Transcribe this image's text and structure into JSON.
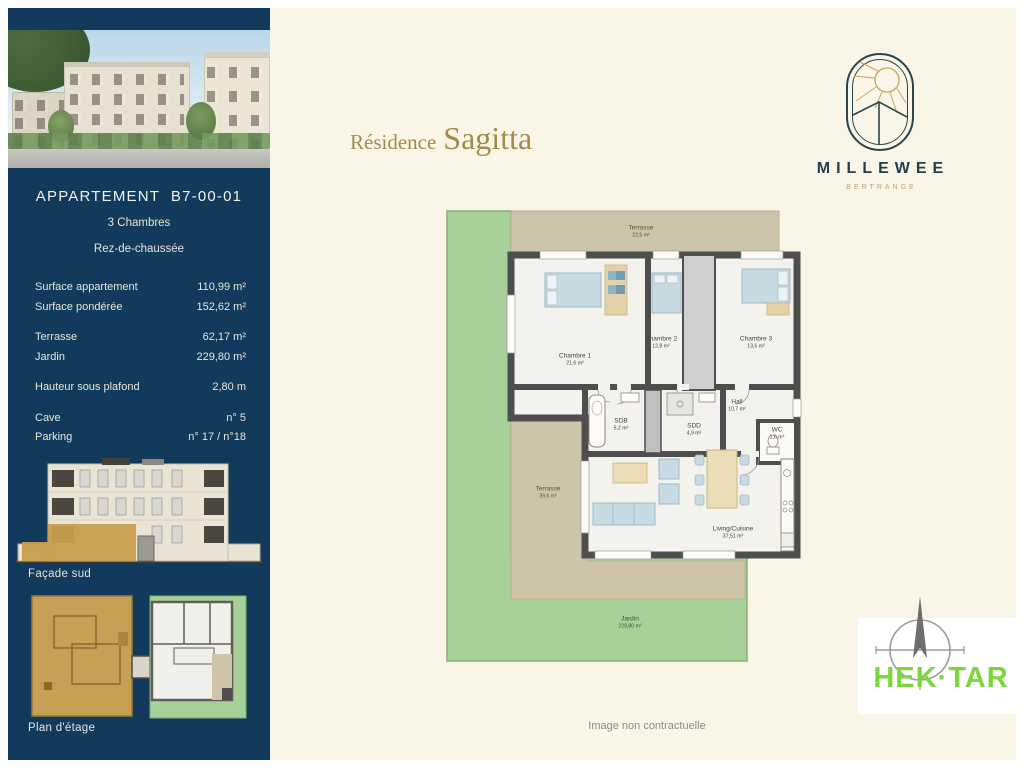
{
  "colors": {
    "sidebar_navy": "#123A5C",
    "cream": "#FAF6E7",
    "gold_title": "#A6894B",
    "garden_green": "#A7D199",
    "terrace_beige": "#CEC4A9",
    "wall_gray": "#4E4E4E",
    "brand_navy": "#21404E",
    "brand_gold": "#C3A566",
    "partner_green": "#7ED63E"
  },
  "sidebar": {
    "heading": "APPARTEMENT",
    "unit": "B7-00-01",
    "subtitle_rooms": "3 Chambres",
    "subtitle_floor": "Rez-de-chaussée",
    "specs": [
      {
        "label": "Surface appartement",
        "value": "110,99 m²"
      },
      {
        "label": "Surface pondérée",
        "value": "152,62 m²"
      },
      {
        "label": "Terrasse",
        "value": "62,17 m²"
      },
      {
        "label": "Jardin",
        "value": "229,80 m²"
      },
      {
        "label": "Hauteur sous plafond",
        "value": "2,80 m"
      },
      {
        "label": "Cave",
        "value": "n° 5"
      },
      {
        "label": "Parking",
        "value": "n° 17 / n°18"
      }
    ],
    "facade_caption": "Façade sud",
    "plan_caption": "Plan d'étage"
  },
  "header": {
    "residence_label": "Résidence",
    "residence_name": "Sagitta"
  },
  "brand": {
    "name": "MILLEWEE",
    "location": "BERTRANGE"
  },
  "floorplan": {
    "rooms": [
      {
        "name": "Terrasse",
        "area": "22,5 m²"
      },
      {
        "name": "Chambre 1",
        "area": "21,6 m²"
      },
      {
        "name": "Chambre 2",
        "area": "12,8 m²"
      },
      {
        "name": "Chambre 3",
        "area": "13,6 m²"
      },
      {
        "name": "SDB",
        "area": "5,2 m²"
      },
      {
        "name": "SDD",
        "area": "4,9 m²"
      },
      {
        "name": "Hall",
        "area": "10,7 m²"
      },
      {
        "name": "WC",
        "area": "1,6 m²"
      },
      {
        "name": "Terrasse",
        "area": "39,6 m²"
      },
      {
        "name": "Living/Cuisine",
        "area": "37,51 m²"
      },
      {
        "name": "Jardin",
        "area": "229,80 m²"
      }
    ]
  },
  "footer": {
    "disclaimer": "Image non contractuelle"
  },
  "partner": {
    "name": "HEK·TAR"
  }
}
